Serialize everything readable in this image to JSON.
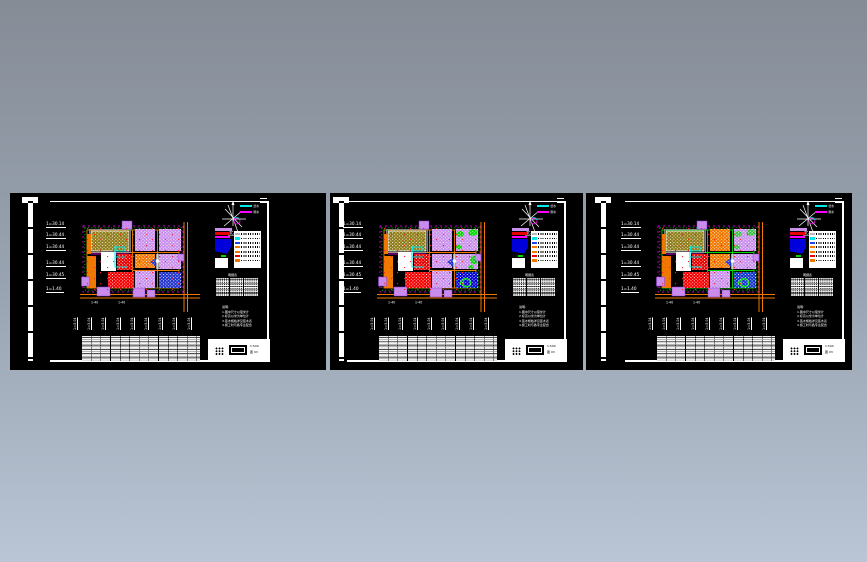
{
  "canvas": {
    "bg_top": "#868c96",
    "bg_mid": "#98a3b1",
    "bg_bottom": "#bac5d5",
    "sheet_bg": "#000000"
  },
  "common": {
    "scale_labels": [
      "1=30.14",
      "1=30.44",
      "1=30.44",
      "1=30.44",
      "1=30.45",
      "1=1.40"
    ],
    "vertical_labels": [
      "1=3.04",
      "1=3.04",
      "1=3.04",
      "1=3.04",
      "1=3.04",
      "1=3.04",
      "1=3.04",
      "1=3.04",
      "1=3.04"
    ],
    "compass_label": "北",
    "line_legend": [
      {
        "color": "#00e8e8",
        "label": "给水"
      },
      {
        "color": "#ff00ff",
        "label": "雨水"
      }
    ],
    "legend_swatches": [
      {
        "color": "#b8b8b8"
      },
      {
        "color": "#00e8e8"
      },
      {
        "color": "#2244ee"
      },
      {
        "color": "#f07800"
      },
      {
        "color": "#f07800"
      },
      {
        "color": "#e80000"
      },
      {
        "color": "#f07800"
      }
    ],
    "material_table_title": "明细表",
    "notes": [
      "说明:",
      "1.图中尺寸以毫米计",
      "2.标高以米为单位计",
      "3.苗木规格详见苗木表",
      "4.施工时与各专业配合"
    ],
    "plan_dim_a": "1-40",
    "plan_dim_b": "1-40",
    "title_block": {
      "line1": "1:500",
      "line2": "图 03"
    }
  },
  "sheets": [
    {
      "name": "sheet-1",
      "plan": {
        "road": "#f07800",
        "tm": "#c990ec",
        "tr": "#c990ec",
        "mc": "#f07800",
        "mr": "#c990ec",
        "bc": "#c990ec",
        "br": "#2233cc",
        "tr_acc": 0,
        "mr_acc": 0,
        "swirl": 0
      }
    },
    {
      "name": "sheet-2",
      "plan": {
        "road": "#f07800",
        "tm": "#c990ec",
        "tr": "#c990ec",
        "mc": "#c990ec",
        "mr": "#c990ec",
        "bc": "#c990ec",
        "br": "#0000d8",
        "tr_acc": 1,
        "mr_acc": 1,
        "swirl": 1
      }
    },
    {
      "name": "sheet-3",
      "plan": {
        "road": "#00d800",
        "tm": "#f07800",
        "tr": "#c990ec",
        "mc": "#f07800",
        "mr": "#c990ec",
        "bc": "#c990ec",
        "br": "#1133cc",
        "tr_acc": 0.7,
        "mr_acc": 0,
        "swirl": 1
      }
    }
  ]
}
